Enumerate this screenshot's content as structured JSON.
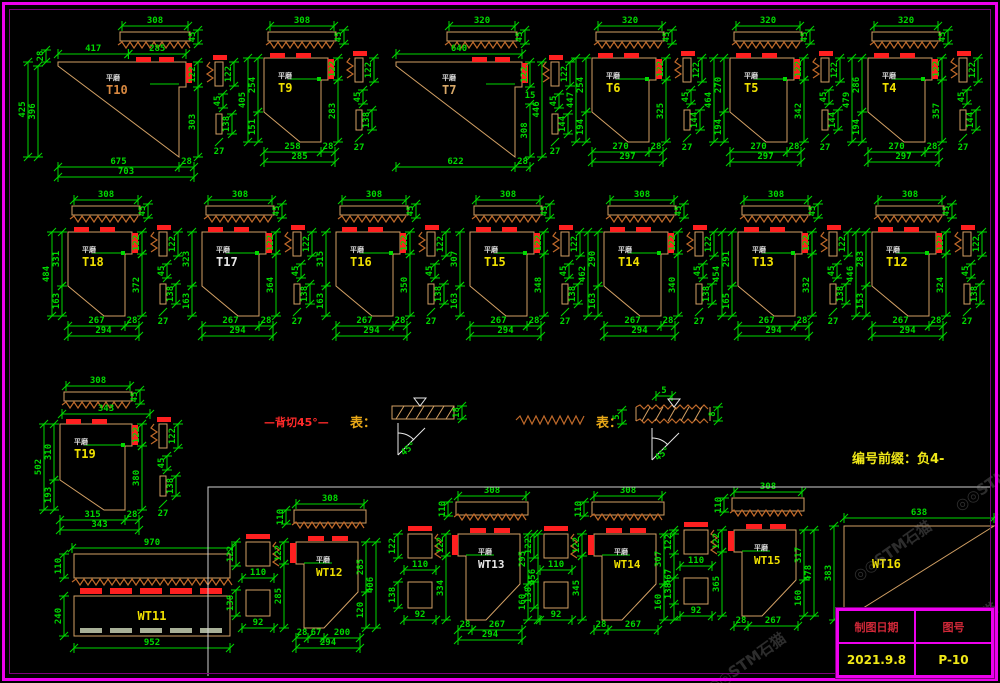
{
  "palette": {
    "background": "#000000",
    "frame": "#ee00ee",
    "frame_inner": "#7c007c",
    "dimension_green": "#00d900",
    "shape_tan": "#d2a064",
    "hatch_brown": "#c06a2a",
    "marking_red": "#ff2020",
    "label_yellow": "#f0e000",
    "label_white": "#e8e8e8",
    "surface_text": "#dcdcdc",
    "gray_dash": "#a8b098",
    "section_line": "#cfcfcf",
    "title_header_red": "#d02838",
    "note_yellow": "#f0e818"
  },
  "surface_mark": "平磨",
  "prefix_note": "编号前缀：负4-",
  "watermark": "◎◎STM石猫",
  "legend": {
    "cut_note": "—背切45°—",
    "symbol1_label": "表：",
    "symbol1_thickness": "18",
    "symbol1_angle": "45°",
    "symbol2_label": "表：",
    "symbol2_top": "5",
    "symbol2_left": "5",
    "symbol2_right": "8",
    "symbol2_angle": "45°"
  },
  "title_block": {
    "header_left": "制图日期",
    "header_right": "图号",
    "date": "2021.9.8",
    "sheet_no": "P-10"
  },
  "details": [
    {
      "id": "T10",
      "label": "T10",
      "type": "tri",
      "x": 30,
      "y": 18,
      "w": 128,
      "sx_off": 28,
      "plank_x": 90,
      "plank": "308",
      "plank_side": "45",
      "top": [
        "417",
        "285"
      ],
      "left": [
        "28",
        "425",
        "396"
      ],
      "right": [
        "122",
        "303"
      ],
      "bottom": [
        "675",
        "28"
      ],
      "total": "703",
      "side": [
        "122",
        "45",
        "138",
        "27"
      ],
      "label_color": "#d88840"
    },
    {
      "id": "T9",
      "label": "T9",
      "type": "pent",
      "x": 252,
      "y": 18,
      "plank": "308",
      "plank_side": "45",
      "left": [
        "405",
        "254",
        "151"
      ],
      "right": [
        "122",
        "283"
      ],
      "bottom": [
        "258",
        "28"
      ],
      "total": "285",
      "side": [
        "122",
        "45",
        "138",
        "27"
      ]
    },
    {
      "id": "T7",
      "label": "T7",
      "type": "tri",
      "x": 392,
      "y": 18,
      "w": 126,
      "sx_off": 4,
      "plank_x": 55,
      "plank": "320",
      "plank_side": "45",
      "top": [
        "640"
      ],
      "left": [],
      "right": [
        "122",
        "15",
        "446",
        "308"
      ],
      "bottom": [
        "622",
        "28"
      ],
      "total": "",
      "side": [
        "122",
        "45",
        "144",
        "27"
      ],
      "label_color": "#d8a868"
    },
    {
      "id": "T6",
      "label": "T6",
      "type": "pent",
      "x": 580,
      "y": 18,
      "plank": "320",
      "plank_side": "45",
      "left": [
        "447",
        "254",
        "194"
      ],
      "right": [
        "122",
        "325"
      ],
      "bottom": [
        "270",
        "28"
      ],
      "total": "297",
      "side": [
        "122",
        "45",
        "144",
        "27"
      ]
    },
    {
      "id": "T5",
      "label": "T5",
      "type": "pent",
      "x": 718,
      "y": 18,
      "plank": "320",
      "plank_side": "45",
      "left": [
        "464",
        "270",
        "194"
      ],
      "right": [
        "122",
        "342"
      ],
      "bottom": [
        "270",
        "28"
      ],
      "total": "297",
      "side": [
        "122",
        "45",
        "144",
        "27"
      ]
    },
    {
      "id": "T4",
      "label": "T4",
      "type": "pent",
      "x": 856,
      "y": 18,
      "plank": "320",
      "plank_side": "45",
      "left": [
        "479",
        "286",
        "194"
      ],
      "right": [
        "122",
        "357"
      ],
      "bottom": [
        "270",
        "28"
      ],
      "total": "297",
      "side": [
        "122",
        "45",
        "144",
        "27"
      ]
    },
    {
      "id": "T18",
      "label": "T18",
      "type": "pent",
      "x": 56,
      "y": 192,
      "plank": "308",
      "plank_side": "45",
      "left": [
        "484",
        "331",
        "163"
      ],
      "right": [
        "122",
        "372"
      ],
      "bottom": [
        "267",
        "28"
      ],
      "total": "294",
      "side": [
        "122",
        "45",
        "138",
        "27"
      ]
    },
    {
      "id": "T17",
      "label": "T17",
      "type": "pent",
      "x": 190,
      "y": 192,
      "plank": "308",
      "plank_side": "45",
      "left": [
        "323",
        "163"
      ],
      "right": [
        "122",
        "364"
      ],
      "bottom": [
        "267",
        "28"
      ],
      "total": "294",
      "side": [
        "122",
        "45",
        "138",
        "27"
      ],
      "label_color": "#e8e8e8"
    },
    {
      "id": "T16",
      "label": "T16",
      "type": "pent",
      "x": 324,
      "y": 192,
      "plank": "308",
      "plank_side": "45",
      "left": [
        "315",
        "163"
      ],
      "right": [
        "122",
        "350"
      ],
      "bottom": [
        "267",
        "28"
      ],
      "total": "294",
      "side": [
        "122",
        "45",
        "138",
        "27"
      ]
    },
    {
      "id": "T15",
      "label": "T15",
      "type": "pent",
      "x": 458,
      "y": 192,
      "plank": "308",
      "plank_side": "45",
      "left": [
        "307",
        "163"
      ],
      "right": [
        "122",
        "348"
      ],
      "bottom": [
        "267",
        "28"
      ],
      "total": "294",
      "side": [
        "122",
        "45",
        "138",
        "27"
      ]
    },
    {
      "id": "T14",
      "label": "T14",
      "type": "pent",
      "x": 592,
      "y": 192,
      "plank": "308",
      "plank_side": "45",
      "left": [
        "462",
        "290",
        "163"
      ],
      "right": [
        "122",
        "340"
      ],
      "bottom": [
        "267",
        "28"
      ],
      "total": "294",
      "side": [
        "122",
        "45",
        "138",
        "27"
      ]
    },
    {
      "id": "T13",
      "label": "T13",
      "type": "pent",
      "x": 726,
      "y": 192,
      "plank": "308",
      "plank_side": "45",
      "left": [
        "454",
        "291",
        "165"
      ],
      "right": [
        "122",
        "332"
      ],
      "bottom": [
        "267",
        "28"
      ],
      "total": "294",
      "side": [
        "122",
        "45",
        "138",
        "27"
      ]
    },
    {
      "id": "T12",
      "label": "T12",
      "type": "pent",
      "x": 860,
      "y": 192,
      "plank": "308",
      "plank_side": "45",
      "left": [
        "446",
        "283",
        "153"
      ],
      "right": [
        "122",
        "324"
      ],
      "bottom": [
        "267",
        "28"
      ],
      "total": "294",
      "side": [
        "122",
        "45",
        "138",
        "27"
      ]
    },
    {
      "id": "T19",
      "label": "T19",
      "type": "pent19",
      "x": 48,
      "y": 378,
      "plank": "308",
      "plank_side": "45",
      "sub": "343",
      "left": [
        "502",
        "310",
        "193"
      ],
      "right": [
        "122",
        "380"
      ],
      "bottom": [
        "315",
        "28"
      ],
      "total": "343",
      "side": [
        "122",
        "45",
        "138",
        "27"
      ]
    },
    {
      "id": "WT11",
      "label": "WT11",
      "type": "wt11",
      "x": 70,
      "y": 538,
      "top": "970",
      "bar1": "110",
      "bar2": "240",
      "bottom": "952"
    },
    {
      "id": "WT12",
      "label": "WT12",
      "type": "wtpent",
      "x": 238,
      "y": 498,
      "squares": [
        "122",
        "110",
        "138",
        "92"
      ],
      "plank": "308",
      "plank_h": "110",
      "left": [
        "122",
        "285"
      ],
      "right": [
        "285",
        "406",
        "120"
      ],
      "bottom": [
        "28",
        "67",
        "200"
      ],
      "total": "294"
    },
    {
      "id": "WT13",
      "label": "WT13",
      "type": "wtpent",
      "x": 400,
      "y": 490,
      "squares": [
        "122",
        "110",
        "138",
        "92"
      ],
      "plank": "308",
      "plank_h": "110",
      "left": [
        "122",
        "334"
      ],
      "right": [
        "295",
        "456",
        "160"
      ],
      "bottom": [
        "28",
        "267"
      ],
      "total": "294",
      "label_color": "#e8e8e8"
    },
    {
      "id": "WT14",
      "label": "WT14",
      "type": "wtpent",
      "x": 536,
      "y": 490,
      "squares": [
        "122",
        "110",
        "138",
        "92"
      ],
      "plank": "308",
      "plank_h": "110",
      "left": [
        "122",
        "345"
      ],
      "right": [
        "307",
        "467",
        "160"
      ],
      "bottom": [
        "28",
        "267"
      ],
      "total": ""
    },
    {
      "id": "WT15",
      "label": "WT15",
      "type": "wtpent",
      "x": 676,
      "y": 486,
      "squares": [
        "122",
        "110",
        "138",
        "92"
      ],
      "plank": "308",
      "plank_h": "110",
      "left": [
        "122",
        "365"
      ],
      "right": [
        "317",
        "478",
        "160"
      ],
      "bottom": [
        "28",
        "267"
      ],
      "total": ""
    },
    {
      "id": "WT16",
      "label": "WT16",
      "type": "wt16",
      "x": 830,
      "y": 510,
      "top": "638",
      "left_dim": "383"
    }
  ]
}
